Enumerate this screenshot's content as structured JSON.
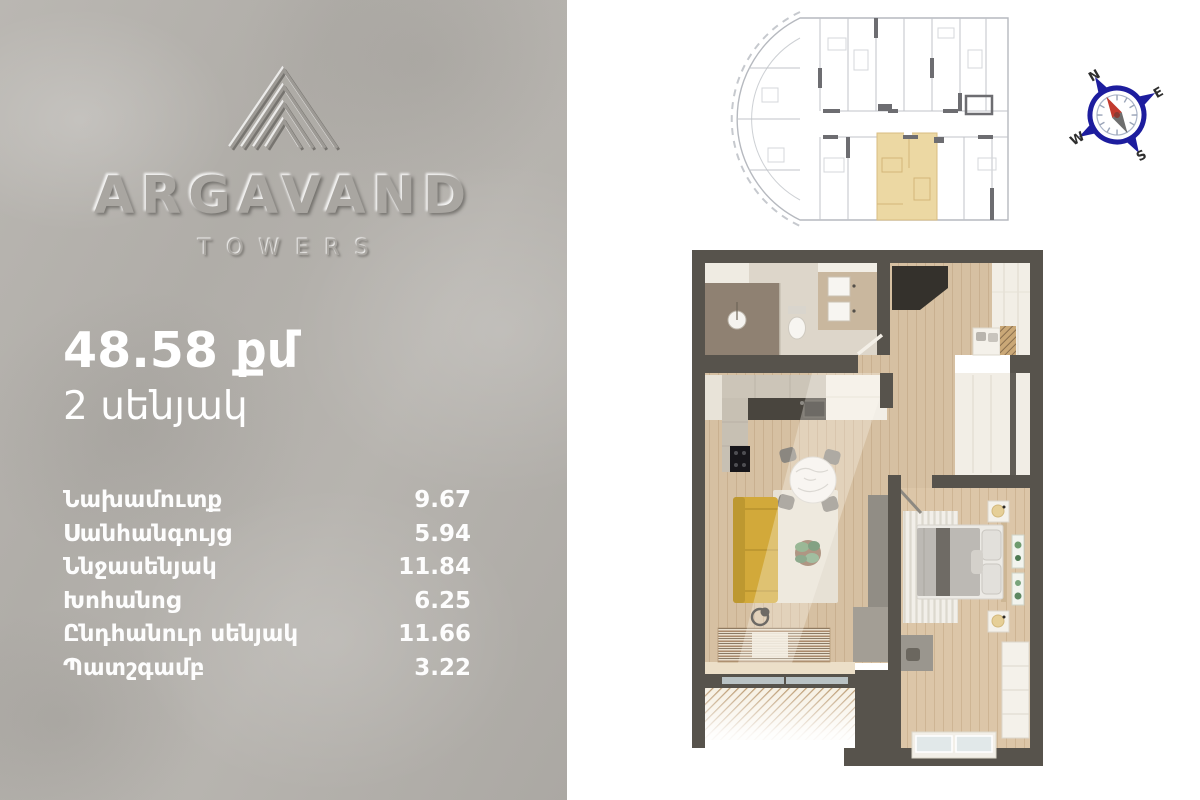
{
  "brand": {
    "name": "ARGAVAND",
    "subtitle": "TOWERS"
  },
  "unit": {
    "area": "48.58 քմ",
    "rooms_count": "2 սենյակ"
  },
  "room_table": {
    "rows": [
      {
        "label": "Նախամուտք",
        "value": "9.67"
      },
      {
        "label": "Սանհանգույց",
        "value": "5.94"
      },
      {
        "label": "Ննջասենյակ",
        "value": "11.84"
      },
      {
        "label": "Խոհանոց",
        "value": "6.25"
      },
      {
        "label": "Ընդհանուր սենյակ",
        "value": "11.66"
      },
      {
        "label": "Պատշգամբ",
        "value": "3.22"
      }
    ]
  },
  "compass": {
    "n": "N",
    "e": "E",
    "s": "S",
    "w": "W"
  },
  "colors": {
    "panel_bg": "#b3b0ab",
    "text": "#ffffff",
    "wall": "#57534c",
    "wood_floor": "#d6c0a2",
    "highlight_unit": "#ecd8a3",
    "sofa_yellow": "#d2a93a",
    "compass_ring": "#1d1d9e",
    "needle_red": "#c23a2e"
  }
}
